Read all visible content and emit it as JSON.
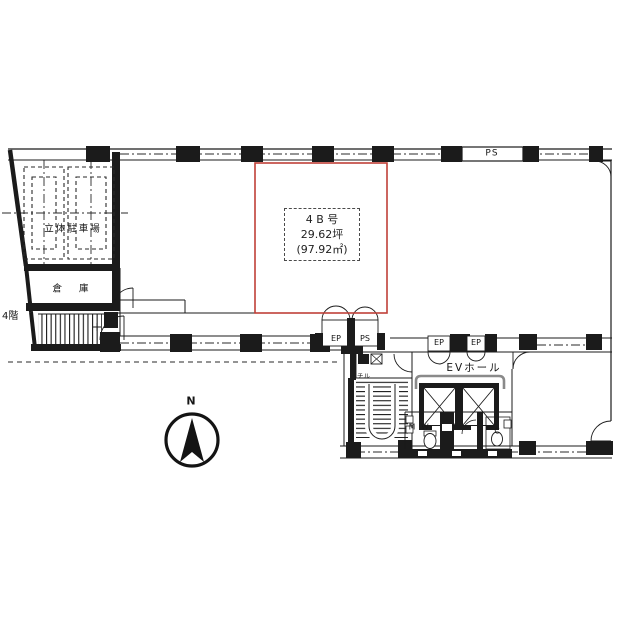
{
  "plan": {
    "unit": {
      "name": "4 B 号",
      "area_tsubo": "29.62坪",
      "area_sqm": "(97.92㎡)"
    },
    "labels": {
      "parking": "立体駐車場",
      "warehouse": "倉 庫",
      "floor_note": "4階",
      "ps_shaft_top": "PS",
      "ep_corridor": "EP",
      "ps_corridor": "PS",
      "ep_hall_1": "EP",
      "ep_hall_2": "EP",
      "ev_hall": "EVホール",
      "utility": "チル",
      "restroom_men": "M",
      "restroom_women": "W",
      "restroom_c": "C",
      "compass_north": "N"
    },
    "colors": {
      "highlight_red": "#bf4038",
      "line_black": "#1b1b1b"
    }
  }
}
